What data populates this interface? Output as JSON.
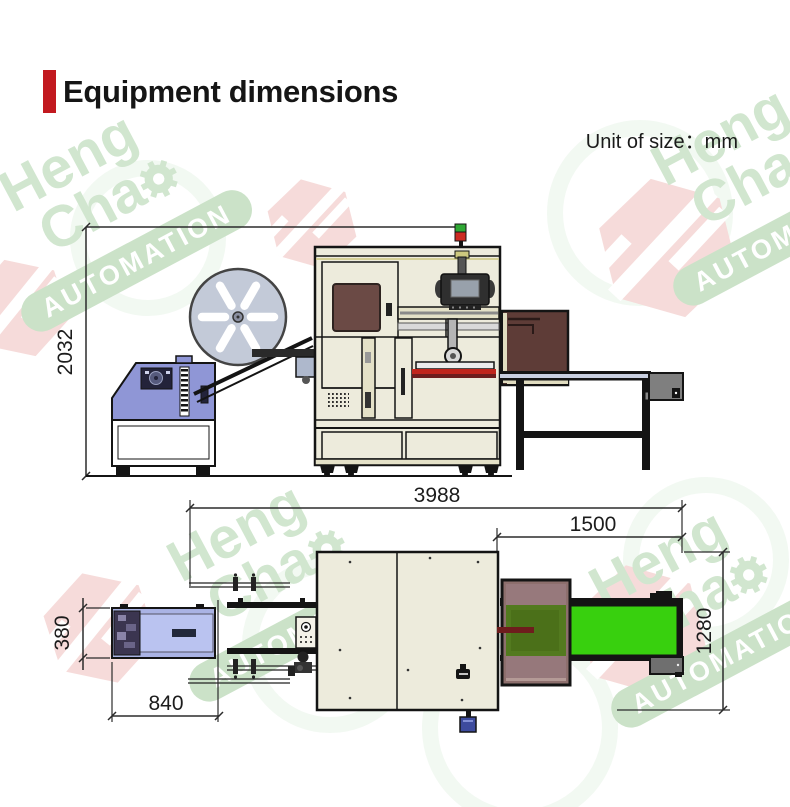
{
  "header": {
    "title": "Equipment dimensions"
  },
  "unit": {
    "label": "Unit of size：mm"
  },
  "dimensions": {
    "machine_height": "2032",
    "total_length": "3988",
    "outfeed_length": "1500",
    "feeder_width": "380",
    "feeder_length": "840",
    "machine_depth": "1280"
  },
  "watermark": {
    "word1": "Heng",
    "word2": "Cha",
    "word3": "AUTOMATION"
  },
  "colors": {
    "accent_red": "#c2191f",
    "title_text": "#151515",
    "line": "#141414",
    "machine_body": "#edebdc",
    "frame_trim": "#cdc87e",
    "feeder_blue": "#8f96d6",
    "feeder_top_blue": "#aab3e4",
    "reel_gray": "#c3cad8",
    "window_brown": "#6b4a45",
    "enclosure_brown": "#5e3c37",
    "enclosure_top_brown": "#8d6f6d",
    "belt_green": "#38d00e",
    "belt_green_shaded": "#537a1f",
    "motor_gray": "#7f7f7f",
    "table_top": "#c9cfe0",
    "lamp_red": "#cc2b22",
    "lamp_green": "#2fa834",
    "watermark_green": "#cfe5cd",
    "watermark_band": "#c9e1c6",
    "watermark_pink": "#f6dad8"
  }
}
